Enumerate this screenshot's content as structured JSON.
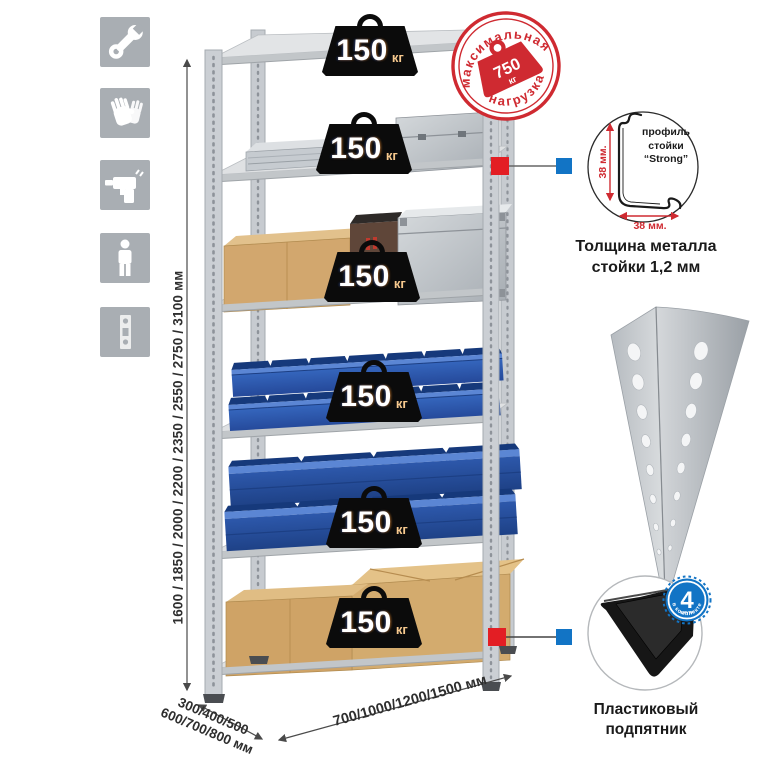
{
  "dimensions": {
    "height": "1600 / 1850 / 2000 / 2200 / 2350 / 2550 / 2750 / 3100 мм",
    "depth_line1": "300/400/500",
    "depth_line2": "600/700/800 мм",
    "width": "700/1000/1200/1500 мм"
  },
  "shelf_load": {
    "value": "150",
    "unit": "кг"
  },
  "stamp": {
    "arc_top": "максимальная",
    "arc_bottom": "нагрузка",
    "value": "750",
    "unit": "кг"
  },
  "profile_detail": {
    "line1": "профиль",
    "line2": "стойки",
    "line3": "“Strong”",
    "dim_vertical": "38 мм.",
    "dim_horizontal": "38 мм.",
    "caption_line1": "Толщина металла",
    "caption_line2": "стойки 1,2 мм"
  },
  "foot_detail": {
    "badge_number": "4",
    "badge_sub": "штуки",
    "badge_arc": "в комплекте",
    "caption_line1": "Пластиковый",
    "caption_line2": "подпятник"
  },
  "icons": {
    "assembly": [
      "wrench-icon",
      "gloves-icon",
      "drill-icon",
      "person-icon",
      "perforated-post-icon"
    ]
  },
  "colors": {
    "stamp_red": "#cf2a31",
    "callout_red": "#e31e24",
    "callout_blue": "#1274c5",
    "bin_blue": "#2e5fb4",
    "cardboard": "#d2a76e",
    "metal_gray": "#c7cbd0"
  }
}
